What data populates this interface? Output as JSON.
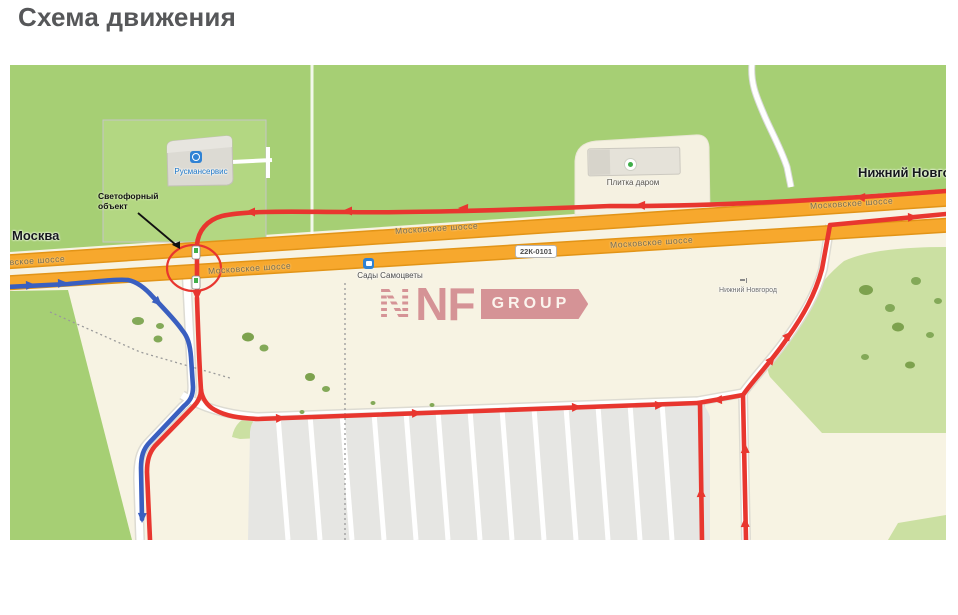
{
  "title": "Схема движения",
  "map": {
    "labels": {
      "moscow": "Москва",
      "nizhny_novgorod": "Нижний Новгород",
      "nizhny_novgorod_small": "Нижний Новгород",
      "highway": "Московское шоссе",
      "road_sign": "22К-0101",
      "traffic_object_line1": "Светофорный",
      "traffic_object_line2": "объект",
      "poi_service": "Русмансервис",
      "poi_store": "Плитка даром",
      "bus_stop": "Сады Самоцветы"
    },
    "icons": {
      "poi_service": "wrench-service-icon",
      "poi_store": "shop-icon",
      "bus_stop": "bus-icon",
      "traffic_light": "traffic-light-icon",
      "city_marker": "city-marker-icon"
    },
    "colors": {
      "route_red": "#e8362f",
      "route_blue": "#3a5fc0",
      "highway_orange": "#f7a82d",
      "highway_casing": "#e29417",
      "green_area": "#a6cf74",
      "light_green": "#cbe0a2",
      "beige": "#f7f3e3",
      "parking_gray": "#e6e6e3",
      "watermark_rose": "#c96f79",
      "title_gray": "#565759"
    }
  },
  "watermark": {
    "n": "N",
    "nf": "NF",
    "group": "GROUP"
  }
}
